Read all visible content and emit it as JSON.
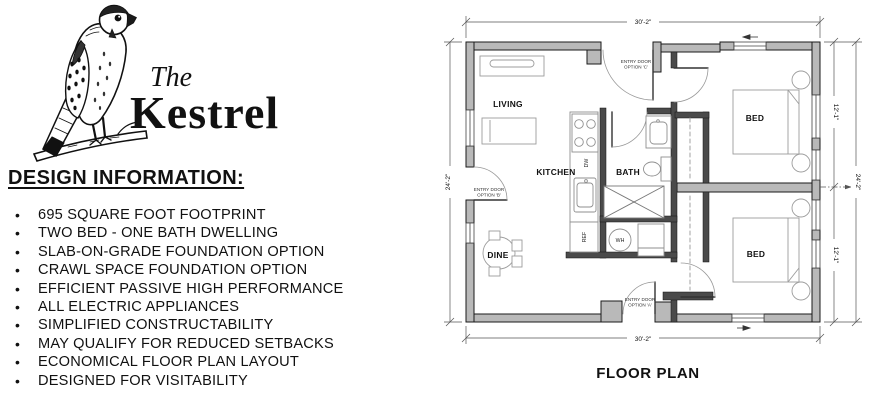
{
  "logo": {
    "the": "The",
    "name": "Kestrel"
  },
  "design_info": {
    "heading": "DESIGN INFORMATION:",
    "bullets": [
      "695 SQUARE FOOT FOOTPRINT",
      "TWO BED - ONE BATH DWELLING",
      "SLAB-ON-GRADE FOUNDATION OPTION",
      "CRAWL SPACE FOUNDATION OPTION",
      "EFFICIENT PASSIVE HIGH PERFORMANCE",
      "ALL ELECTRIC APPLIANCES",
      "SIMPLIFIED CONSTRUCTABILITY",
      "MAY QUALIFY FOR REDUCED SETBACKS",
      "ECONOMICAL FLOOR PLAN LAYOUT",
      "DESIGNED FOR VISITABILITY"
    ]
  },
  "floor_plan": {
    "title": "FLOOR PLAN",
    "rooms": {
      "living": "LIVING",
      "kitchen": "KITCHEN",
      "bath": "BATH",
      "dine": "DINE",
      "bed_top": "BED",
      "bed_bottom": "BED"
    },
    "appliances": {
      "dishwasher": "DW",
      "refrigerator": "REF",
      "water_heater": "WH"
    },
    "dimensions": {
      "width_top": "30'-2\"",
      "width_bottom": "30'-2\"",
      "height_left": "24'-2\"",
      "height_right": "24'-2\"",
      "bed_top_height": "12'-1\"",
      "bed_bottom_height": "12'-1\""
    },
    "entry_doors": {
      "c_line1": "ENTRY DOOR",
      "c_line2": "OPTION 'C'",
      "b_line1": "ENTRY DOOR",
      "b_line2": "OPTION 'B'",
      "a_line1": "ENTRY DOOR",
      "a_line2": "OPTION 'A'"
    },
    "colors": {
      "wall_fill": "#b9b9b9",
      "wall_stroke": "#1a1a1a",
      "interior_wall": "#4a4a4a",
      "fixture_line": "#8f8f8f",
      "furniture_line": "#9c9c9c",
      "dimension_line": "#555555",
      "text": "#111111"
    }
  }
}
